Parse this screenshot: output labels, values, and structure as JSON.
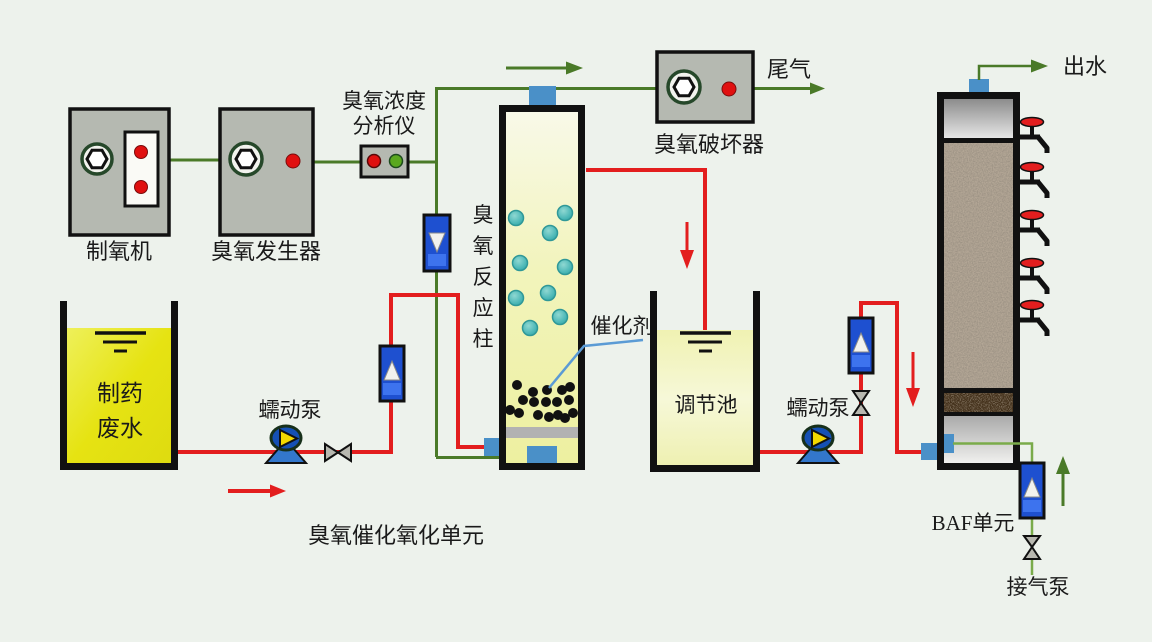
{
  "diagram": {
    "title": "臭氧催化氧化单元",
    "colors": {
      "background": "#edf2ec",
      "gas_pipe_green": "#4a7a28",
      "liquid_pipe_red": "#e31e1e",
      "equipment_gray": "#b5b9b1",
      "flowmeter_blue": "#1e50d0",
      "port_blue": "#4a90c8",
      "wastewater_yellow": "#e6e312",
      "regulating_pale_yellow": "#f3f5c6",
      "bubble_teal": "#45b4b4",
      "indicator_red": "#e01010",
      "indicator_green": "#5aa81e",
      "catalyst_pointer_blue": "#5b9bd5"
    },
    "components": {
      "oxygen_generator": {
        "label": "制氧机"
      },
      "ozone_generator": {
        "label": "臭氧发生器"
      },
      "ozone_analyzer": {
        "label_line1": "臭氧浓度",
        "label_line2": "分析仪"
      },
      "ozone_reaction_column": {
        "label": "臭氧反应柱",
        "chars": [
          "臭",
          "氧",
          "反",
          "应",
          "柱"
        ]
      },
      "ozone_destructor": {
        "label": "臭氧破坏器"
      },
      "tail_gas": {
        "label": "尾气"
      },
      "catalyst": {
        "label": "催化剂"
      },
      "wastewater_tank": {
        "label_line1": "制药",
        "label_line2": "废水"
      },
      "peristaltic_pump_1": {
        "label": "蠕动泵"
      },
      "regulating_tank": {
        "label": "调节池"
      },
      "peristaltic_pump_2": {
        "label": "蠕动泵"
      },
      "baf_unit": {
        "label": "BAF单元"
      },
      "effluent": {
        "label": "出水"
      },
      "air_pump": {
        "label": "接气泵"
      }
    }
  }
}
